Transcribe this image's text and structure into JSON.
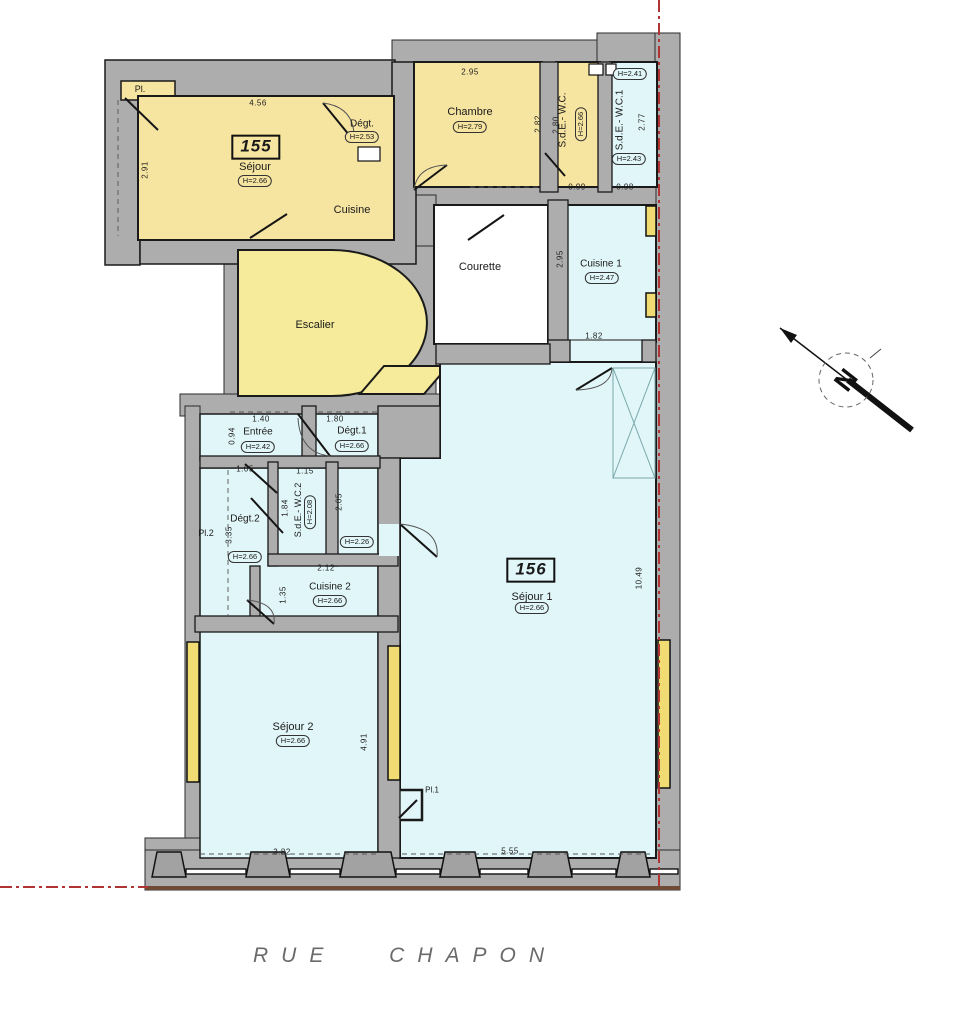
{
  "street": {
    "label": "RUE CHAPON"
  },
  "north": {
    "label": "N"
  },
  "colors": {
    "wall": "#ADADAD",
    "yellow": "#F6E4A1",
    "stair": "#F5EB9B",
    "window": "#F0DC72",
    "blue": "#E1F6F8",
    "white": "#FFFFFF",
    "red": "#B13434",
    "brown": "#6F4B36"
  },
  "plan": {
    "wall_rects": [
      [
        392,
        40,
        208,
        24
      ],
      [
        597,
        33,
        83,
        31
      ],
      [
        655,
        33,
        25,
        857
      ],
      [
        416,
        185,
        240,
        22
      ],
      [
        416,
        195,
        20,
        212
      ],
      [
        224,
        246,
        212,
        152
      ],
      [
        180,
        394,
        260,
        22
      ],
      [
        185,
        406,
        15,
        452
      ],
      [
        145,
        838,
        55,
        52
      ],
      [
        145,
        850,
        535,
        40
      ]
    ],
    "wall_paths": [
      "M105,60 H395 V98 H140 V265 H105 Z",
      "M392,62 H416 V264 H140 V236 H392 Z"
    ],
    "rooms": [
      {
        "name": "pl-155",
        "fill": "yellow",
        "x": 121,
        "y": 81,
        "w": 54,
        "h": 19,
        "sw": 1.5
      },
      {
        "name": "sejour-155",
        "fill": "yellow",
        "x": 138,
        "y": 96,
        "w": 256,
        "h": 144
      },
      {
        "name": "chambre",
        "fill": "yellow",
        "x": 414,
        "y": 62,
        "w": 128,
        "h": 125
      },
      {
        "name": "sde-wc",
        "fill": "yellow",
        "x": 556,
        "y": 62,
        "w": 44,
        "h": 125
      },
      {
        "name": "sde-wc1",
        "fill": "blue",
        "x": 610,
        "y": 62,
        "w": 47,
        "h": 125
      },
      {
        "name": "courette",
        "fill": "white",
        "x": 434,
        "y": 205,
        "w": 114,
        "h": 139
      },
      {
        "name": "cuisine1",
        "fill": "blue",
        "x": 566,
        "y": 205,
        "w": 90,
        "h": 137
      },
      {
        "name": "cuisine1-opening",
        "fill": "blue",
        "x": 568,
        "y": 340,
        "w": 74,
        "h": 24,
        "sw": 1
      },
      {
        "name": "escalier",
        "fill": "stair",
        "path": "M238,250 L332,250 A95,73 0 0 1 332,396 L238,396 Z"
      },
      {
        "name": "stair-landing",
        "fill": "stair",
        "path": "M384,366 L448,366 L424,394 L360,394 Z"
      },
      {
        "name": "entree-degt-row",
        "fill": "blue",
        "x": 200,
        "y": 414,
        "w": 178,
        "h": 46,
        "sw": 1.5
      },
      {
        "name": "sejour1",
        "fill": "blue",
        "path": "M440,362 L656,362 L656,858 L400,858 L400,458 L440,458 Z"
      },
      {
        "name": "left-rooms",
        "fill": "blue",
        "x": 200,
        "y": 468,
        "w": 178,
        "h": 390,
        "sw": 1.5
      },
      {
        "name": "pl1-closet",
        "fill": "blue",
        "x": 394,
        "y": 790,
        "w": 28,
        "h": 30,
        "sw": 2.5
      }
    ],
    "inner_walls": [
      [
        540,
        62,
        18,
        130
      ],
      [
        598,
        62,
        14,
        130
      ],
      [
        548,
        200,
        20,
        148
      ],
      [
        548,
        340,
        22,
        22
      ],
      [
        642,
        340,
        14,
        22
      ],
      [
        436,
        344,
        114,
        20
      ],
      [
        302,
        406,
        14,
        56
      ],
      [
        378,
        406,
        62,
        52
      ],
      [
        378,
        458,
        22,
        400
      ],
      [
        200,
        456,
        180,
        12
      ],
      [
        268,
        462,
        10,
        104
      ],
      [
        326,
        462,
        12,
        104
      ],
      [
        268,
        554,
        130,
        12
      ],
      [
        250,
        566,
        10,
        52
      ],
      [
        195,
        616,
        203,
        16
      ]
    ],
    "gap_fills": [
      [
        379,
        524,
        20,
        32
      ]
    ],
    "windows": [
      [
        646,
        206,
        10,
        30
      ],
      [
        646,
        293,
        10,
        24
      ],
      [
        658,
        640,
        12,
        148
      ],
      [
        187,
        642,
        12,
        140
      ],
      [
        388,
        646,
        12,
        134
      ]
    ],
    "fixtures": [
      [
        358,
        147,
        22,
        14
      ],
      [
        589,
        64,
        14,
        11
      ],
      [
        606,
        64,
        10,
        11
      ]
    ],
    "pillars": [
      [
        152,
        34
      ],
      [
        246,
        44
      ],
      [
        340,
        56
      ],
      [
        440,
        40
      ],
      [
        528,
        44
      ],
      [
        616,
        34
      ]
    ],
    "sills": [
      [
        186,
        60
      ],
      [
        290,
        50
      ],
      [
        396,
        44
      ],
      [
        480,
        48
      ],
      [
        572,
        44
      ],
      [
        650,
        28
      ]
    ],
    "brown_edge": [
      145,
      886,
      535,
      4
    ],
    "shaft": {
      "x": 613,
      "y": 368,
      "w": 42,
      "h": 110
    },
    "doors": [
      [
        125,
        98,
        158,
        130
      ],
      [
        323,
        103,
        354,
        141
      ],
      [
        250,
        238,
        287,
        214
      ],
      [
        414,
        190,
        447,
        165
      ],
      [
        468,
        240,
        504,
        215
      ],
      [
        545,
        153,
        565,
        176
      ],
      [
        298,
        414,
        330,
        456
      ],
      [
        245,
        464,
        277,
        493
      ],
      [
        251,
        498,
        283,
        533
      ],
      [
        247,
        600,
        274,
        624
      ],
      [
        400,
        524,
        437,
        557
      ],
      [
        576,
        390,
        612,
        368
      ],
      [
        399,
        818,
        417,
        800
      ]
    ],
    "arcs": [
      "M330,456 Q300,453 298,418",
      "M437,557 Q440,528 400,524",
      "M414,190 Q417,166 447,165",
      "M323,103 Q356,107 354,141",
      "M247,600 Q277,603 274,624",
      "M576,390 Q611,389 612,368"
    ],
    "dashes": [
      [
        200,
        854,
        378,
        854
      ],
      [
        402,
        854,
        654,
        854
      ],
      [
        230,
        412,
        288,
        412
      ],
      [
        318,
        412,
        378,
        412
      ],
      [
        228,
        470,
        228,
        616
      ],
      [
        118,
        100,
        118,
        236
      ],
      [
        470,
        187,
        538,
        187
      ]
    ],
    "unit_boxes": [
      {
        "number": "155",
        "cx": 256,
        "cy": 147
      },
      {
        "number": "156",
        "cx": 531,
        "cy": 570
      }
    ],
    "room_labels": [
      {
        "text": "Pl.",
        "cx": 140,
        "cy": 90,
        "size": 9
      },
      {
        "text": "Séjour",
        "cx": 255,
        "cy": 167
      },
      {
        "text": "Dégt.",
        "cx": 362,
        "cy": 124,
        "size": 10
      },
      {
        "text": "Cuisine",
        "cx": 352,
        "cy": 210
      },
      {
        "text": "Chambre",
        "cx": 470,
        "cy": 112
      },
      {
        "text": "S.d.E.- W.C.",
        "cx": 563,
        "cy": 120,
        "size": 10,
        "rot": true
      },
      {
        "text": "S.d.E.- W.C.1",
        "cx": 620,
        "cy": 120,
        "size": 10,
        "rot": true
      },
      {
        "text": "Courette",
        "cx": 480,
        "cy": 267
      },
      {
        "text": "Cuisine 1",
        "cx": 601,
        "cy": 264,
        "size": 10
      },
      {
        "text": "Escalier",
        "cx": 315,
        "cy": 325
      },
      {
        "text": "Entrée",
        "cx": 258,
        "cy": 432,
        "size": 10
      },
      {
        "text": "Dégt.1",
        "cx": 352,
        "cy": 431,
        "size": 10
      },
      {
        "text": "S.d.E.- W.C.2",
        "cx": 299,
        "cy": 510,
        "size": 9,
        "rot": true
      },
      {
        "text": "Dégt.2",
        "cx": 245,
        "cy": 519,
        "size": 10
      },
      {
        "text": "Pl.2",
        "cx": 206,
        "cy": 534,
        "size": 9
      },
      {
        "text": "Cuisine 2",
        "cx": 330,
        "cy": 587,
        "size": 10
      },
      {
        "text": "Séjour 2",
        "cx": 293,
        "cy": 727
      },
      {
        "text": "Séjour 1",
        "cx": 532,
        "cy": 597
      },
      {
        "text": "Pl.1",
        "cx": 432,
        "cy": 791,
        "size": 8
      }
    ],
    "height_badges": [
      {
        "text": "H=2.66",
        "cx": 255,
        "cy": 181,
        "bg": "yellow"
      },
      {
        "text": "H=2.53",
        "cx": 362,
        "cy": 137,
        "bg": "yellow"
      },
      {
        "text": "H=2.79",
        "cx": 470,
        "cy": 127,
        "bg": "yellow"
      },
      {
        "text": "H=2.66",
        "cx": 581,
        "cy": 124,
        "bg": "yellow",
        "rot": true
      },
      {
        "text": "H=2.41",
        "cx": 630,
        "cy": 74,
        "bg": "blue"
      },
      {
        "text": "H=2.43",
        "cx": 629,
        "cy": 159,
        "bg": "blue"
      },
      {
        "text": "H=2.47",
        "cx": 602,
        "cy": 278,
        "bg": "blue"
      },
      {
        "text": "H=2.42",
        "cx": 258,
        "cy": 447,
        "bg": "blue"
      },
      {
        "text": "H=2.66",
        "cx": 352,
        "cy": 446,
        "bg": "blue"
      },
      {
        "text": "H=2.08",
        "cx": 310,
        "cy": 512,
        "bg": "blue",
        "rot": true
      },
      {
        "text": "H=2.26",
        "cx": 357,
        "cy": 542,
        "bg": "blue"
      },
      {
        "text": "H=2.66",
        "cx": 245,
        "cy": 557,
        "bg": "blue"
      },
      {
        "text": "H=2.66",
        "cx": 330,
        "cy": 601,
        "bg": "blue"
      },
      {
        "text": "H=2.66",
        "cx": 293,
        "cy": 741,
        "bg": "blue"
      },
      {
        "text": "H=2.66",
        "cx": 532,
        "cy": 608,
        "bg": "blue"
      }
    ],
    "dim_labels": [
      {
        "text": "4.56",
        "cx": 258,
        "cy": 104
      },
      {
        "text": "2.95",
        "cx": 470,
        "cy": 73
      },
      {
        "text": "0.99",
        "cx": 577,
        "cy": 188
      },
      {
        "text": "0.98",
        "cx": 625,
        "cy": 188
      },
      {
        "text": "1.82",
        "cx": 594,
        "cy": 337
      },
      {
        "text": "1.40",
        "cx": 261,
        "cy": 420
      },
      {
        "text": "1.80",
        "cx": 335,
        "cy": 420
      },
      {
        "text": "1.05",
        "cx": 245,
        "cy": 470
      },
      {
        "text": "1.15",
        "cx": 305,
        "cy": 472
      },
      {
        "text": "2.12",
        "cx": 326,
        "cy": 569
      },
      {
        "text": "3.82",
        "cx": 282,
        "cy": 853
      },
      {
        "text": "5.55",
        "cx": 510,
        "cy": 852
      },
      {
        "text": "2.91",
        "cx": 146,
        "cy": 170,
        "rot": true
      },
      {
        "text": "2.82",
        "cx": 539,
        "cy": 124,
        "rot": true
      },
      {
        "text": "2.80",
        "cx": 557,
        "cy": 125,
        "rot": true
      },
      {
        "text": "2.77",
        "cx": 643,
        "cy": 122,
        "rot": true
      },
      {
        "text": "2.95",
        "cx": 561,
        "cy": 259,
        "rot": true
      },
      {
        "text": "0.94",
        "cx": 233,
        "cy": 436,
        "rot": true
      },
      {
        "text": "1.84",
        "cx": 286,
        "cy": 508,
        "rot": true
      },
      {
        "text": "2.05",
        "cx": 340,
        "cy": 502,
        "rot": true
      },
      {
        "text": "3.35",
        "cx": 230,
        "cy": 535,
        "rot": true
      },
      {
        "text": "1.35",
        "cx": 284,
        "cy": 595,
        "rot": true
      },
      {
        "text": "4.91",
        "cx": 365,
        "cy": 742,
        "rot": true
      },
      {
        "text": "10.49",
        "cx": 640,
        "cy": 578,
        "rot": true
      }
    ]
  }
}
